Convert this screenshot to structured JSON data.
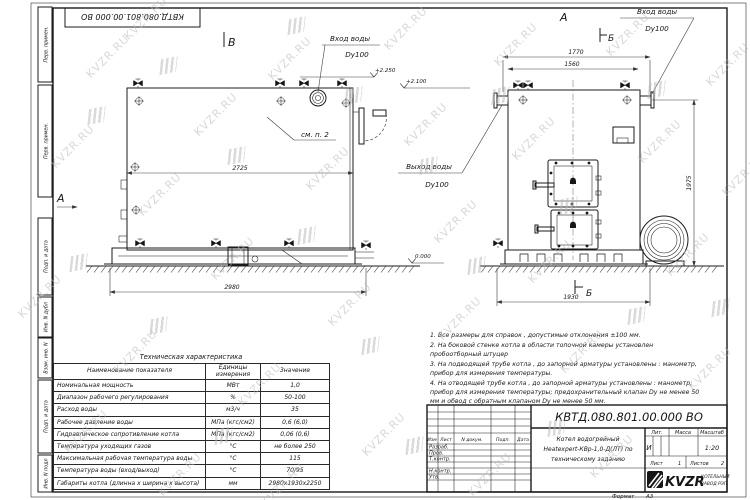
{
  "watermark": {
    "text": "KVZR.RU"
  },
  "sheet": {
    "doc_number_top": "КВТД.080.801.00.000 ВО",
    "margin_labels": [
      "Перв. примен.",
      "Перв. примен.",
      "Подп. и дата",
      "Инв. N дубл",
      "Взам. инв. N",
      "Подп. и дата",
      "Инв. N подл"
    ],
    "format_label": "Формат",
    "format_value": "А3"
  },
  "drawing": {
    "view_labels": {
      "b": "В",
      "a_left": "А",
      "a_top": "А",
      "sec_b_top": "Б",
      "sec_b_bottom": "Б"
    },
    "callouts": {
      "inlet_left_1": "Вход воды",
      "inlet_left_2": "Dy100",
      "inlet_right_1": "Вход воды",
      "inlet_right_2": "Dy100",
      "outlet_1": "Выход воды",
      "outlet_2": "Dy100",
      "see_note": "см. п. 2"
    },
    "elevations": {
      "top": "+2.250",
      "mid": "+2.100",
      "zero": "0.000"
    },
    "dimensions": {
      "side_top": "2725",
      "side_bottom": "2980",
      "front_outer": "1770",
      "front_inner": "1560",
      "front_height": "1975",
      "front_base": "1930"
    }
  },
  "notes": [
    "1.  Все размеры для справок , допустимые отклонения  ±100 мм.",
    "2.  На боковой стенке котла в области топочной камеры установлен пробоотборный штуцер",
    "3.  На подводящей трубе котла , до запорной арматуры установлены :  манометр, прибор для измерения температуры.",
    "4.  На отводящей трубе котла , до запорной арматуры установлены :  манометр, прибор для измерения температуры; предохранительный клапан  Dу не менее  50 мм и обвод с обратным клапаном  Dу не менее 50 мм."
  ],
  "tech_table": {
    "title": "Техническая характеристика",
    "headers": [
      "Наименование показателя",
      "Единицы измерения",
      "Значение"
    ],
    "rows": [
      [
        "Номинальная мощность",
        "МВт",
        "1,0"
      ],
      [
        "Диапазон рабочего регулирования",
        "%",
        "50-100"
      ],
      [
        "Расход воды",
        "м3/ч",
        "35"
      ],
      [
        "Рабочее давление воды",
        "МПа (кгс/см2)",
        "0,6 (6,0)"
      ],
      [
        "Гидравлическое сопротивление котла",
        "МПа (кгс/см2)",
        "0,06 (0,6)"
      ],
      [
        "Температура уходящих газов",
        "°С",
        "не более 250"
      ],
      [
        "Максимальная рабочая температура воды",
        "°С",
        "115"
      ],
      [
        "Температура воды (вход/выход)",
        "°С",
        "70/95"
      ],
      [
        "Габариты котла (длинна х ширина х высота)",
        "мм",
        "2980х1930х2250"
      ]
    ]
  },
  "title_block": {
    "doc_number": "КВТД.080.801.00.000  ВО",
    "name_line1": "Котел водогрейный",
    "name_line2": "Heatexpert-КВр-1,0-Д(ЛТ) по",
    "name_line3": "техническому заданию",
    "cols": [
      "Изм",
      "Лист",
      "N докум.",
      "Подп.",
      "Дата"
    ],
    "sig_labels": [
      "Разраб.",
      "Пров.",
      "Т.контр.",
      "Н.контр.",
      "Утв."
    ],
    "lit_label": "Лит.",
    "mass_label": "Масса",
    "scale_label": "Масштаб",
    "lit_value": "И",
    "scale_value": "1:20",
    "sheet_label": "Лист",
    "sheet_value": "1",
    "sheets_label": "Листов",
    "sheets_value": "2",
    "logo_text": "KVZR",
    "company_line1": "КОТЕЛЬНЫЙ",
    "company_line2": "ЗАВОД РЭП"
  }
}
